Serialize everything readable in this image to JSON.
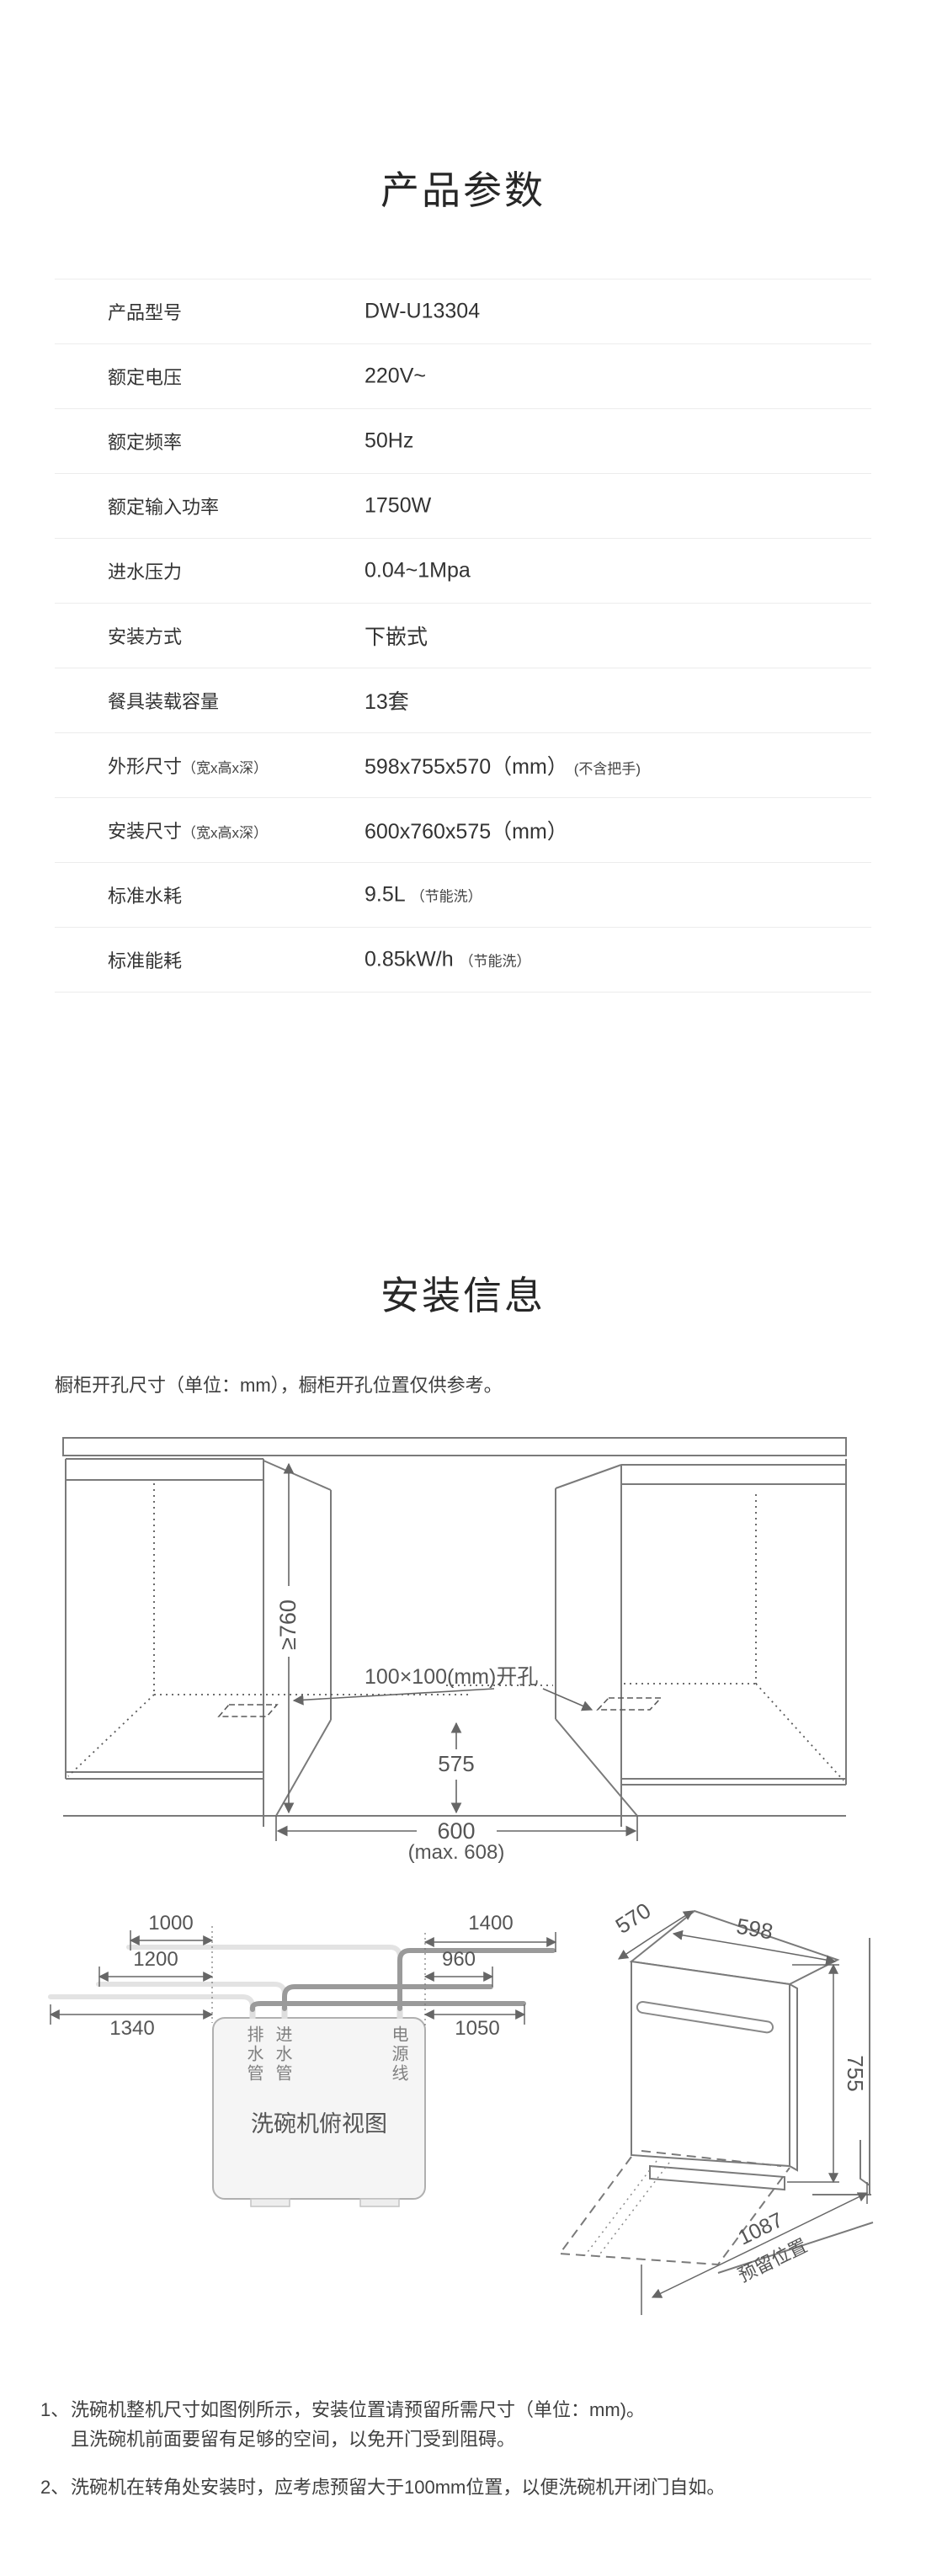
{
  "product_params": {
    "title": "产品参数",
    "rows": [
      {
        "label": "产品型号",
        "value": "DW-U13304"
      },
      {
        "label": "额定电压",
        "value": "220V~"
      },
      {
        "label": "额定频率",
        "value": "50Hz"
      },
      {
        "label": "额定输入功率",
        "value": "1750W"
      },
      {
        "label": "进水压力",
        "value": "0.04~1Mpa"
      },
      {
        "label": "安装方式",
        "value": "下嵌式"
      },
      {
        "label": "餐具装载容量",
        "value": "13套"
      },
      {
        "label": "外形尺寸",
        "label_suffix": "（宽x高x深）",
        "value": "598x755x570（mm）",
        "value_suffix": "(不含把手)"
      },
      {
        "label": "安装尺寸",
        "label_suffix": "（宽x高x深）",
        "value": "600x760x575（mm）"
      },
      {
        "label": "标准水耗",
        "value": "9.5L",
        "value_suffix": "（节能洗）"
      },
      {
        "label": "标准能耗",
        "value": "0.85kW/h",
        "value_suffix": "（节能洗）"
      }
    ]
  },
  "install_info": {
    "title": "安装信息",
    "subtitle": "橱柜开孔尺寸（单位：mm），橱柜开孔位置仅供参考。",
    "cutout": {
      "height": "≥760",
      "hole": "100×100(mm)开孔",
      "depth": "575",
      "width": "600",
      "width_max": "(max. 608)"
    },
    "hoses": {
      "title": "洗碗机俯视图",
      "drain": "排水管",
      "inlet": "进水管",
      "power": "电源线",
      "left_dims": [
        "1000",
        "1200",
        "1340"
      ],
      "right_dims": [
        "1400",
        "960",
        "1050"
      ]
    },
    "machine": {
      "depth": "570",
      "width": "598",
      "height": "755",
      "reserve": "1087",
      "reserve_label": "预留位置"
    },
    "notes": [
      {
        "num": "1、",
        "line1": "洗碗机整机尺寸如图例所示，安装位置请预留所需尺寸（单位：mm)。",
        "line2": "且洗碗机前面要留有足够的空间，以免开门受到阻碍。"
      },
      {
        "num": "2、",
        "line1": "洗碗机在转角处安装时，应考虑预留大于100mm位置，以便洗碗机开闭门自如。"
      }
    ]
  },
  "colors": {
    "line": "#7a7a7a",
    "dim": "#666666",
    "hose_light": "#e3e3e3",
    "hose_dark": "#9a9a9a",
    "box_fill": "#f5f5f5"
  }
}
